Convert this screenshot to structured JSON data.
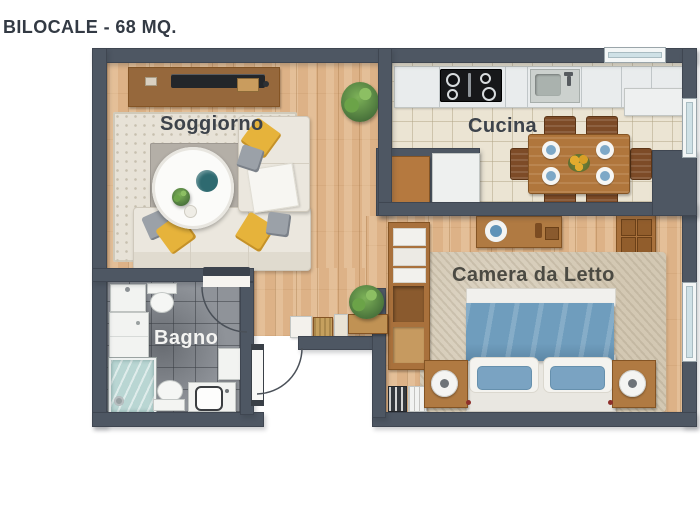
{
  "title": "BILOCALE - 68 MQ.",
  "plan": {
    "type": "floor-plan",
    "rooms": [
      {
        "id": "soggiorno",
        "label": "Soggiorno"
      },
      {
        "id": "cucina",
        "label": "Cucina"
      },
      {
        "id": "bagno",
        "label": "Bagno"
      },
      {
        "id": "camera_da_letto",
        "label": "Camera da Letto"
      }
    ]
  },
  "colors": {
    "wall": "#4e5763",
    "wood_floor": "#ddb287",
    "kitchen_tile": "#ebe4d3",
    "bath_tile": "#8f9399",
    "duvet_blue": "#6f9dbd",
    "pillow_yellow": "#e6b33b",
    "furniture_wood": "#b07a42",
    "title_text": "#333a44"
  }
}
